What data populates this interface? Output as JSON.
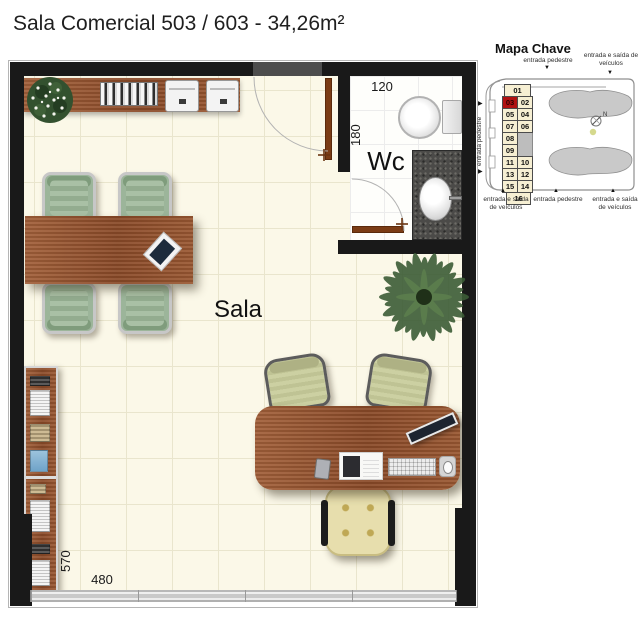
{
  "title": "Sala Comercial 503 / 603 - 34,26m²",
  "plan": {
    "room_label": "Sala",
    "wc_label": "Wc",
    "dim_wc_width": "120",
    "dim_wc_depth": "180",
    "dim_room_depth": "570",
    "dim_room_width": "480",
    "colors": {
      "wall": "#191919",
      "floor": "#fbf8e8",
      "wood": "#9a5a35",
      "door": "#7b3c15",
      "meeting_chair_green": "#9cb59a",
      "granite_counter": "#4b4a48"
    }
  },
  "key_map": {
    "title": "Mapa Chave",
    "highlighted_unit": "03",
    "highlight_color": "#b01010",
    "compass_label": "N",
    "rows": [
      [
        "01"
      ],
      [
        "03",
        "02"
      ],
      [
        "05",
        "04"
      ],
      [
        "07",
        "06"
      ],
      [
        "08"
      ],
      [
        "09"
      ],
      [
        "11",
        "10"
      ],
      [
        "13",
        "12"
      ],
      [
        "15",
        "14"
      ],
      [
        "16"
      ]
    ],
    "labels": {
      "top_pedestrian": "entrada pedestre",
      "top_vehicles": "entrada e saída de veículos",
      "left_pedestrian": "entrada pedestre",
      "bottom_vehicles_left": "entrada e saída de veículos",
      "bottom_pedestrian": "entrada pedestre",
      "bottom_vehicles_right": "entrada e saída de veículos"
    }
  },
  "icons": {
    "arrow_down": "▼",
    "arrow_up": "▲",
    "arrow_right": "▶"
  }
}
